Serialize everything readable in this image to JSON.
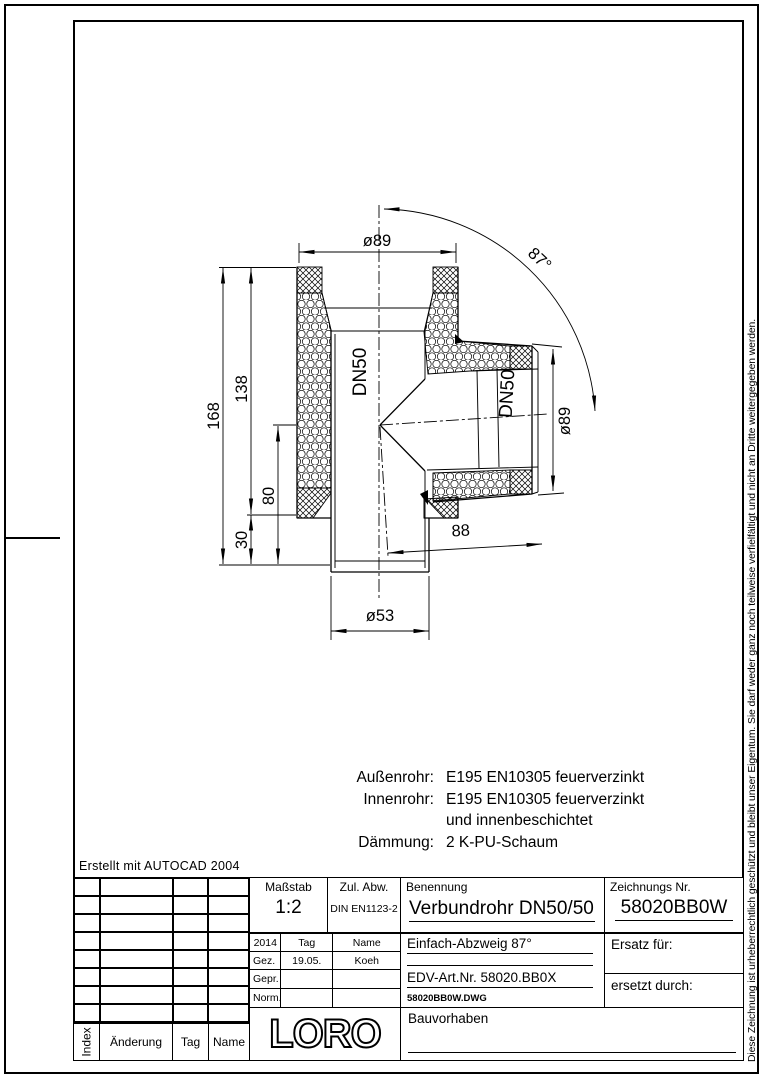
{
  "frame": {
    "created_with": "Erstellt mit AUTOCAD 2004",
    "copyright": "Diese Zeichnung ist urheberrechtlich geschützt und bleibt unser Eigentum. Sie darf weder ganz noch teilweise verfielfältigt und nicht an Dritte weitergegeben werden."
  },
  "drawing": {
    "dims": {
      "dia_top": "ø89",
      "angle": "87°",
      "dn_main": "DN50",
      "dn_branch": "DN50",
      "dia_branch": "ø89",
      "h_total": "168",
      "h_upper": "138",
      "h_branch": "80",
      "h_bottom": "30",
      "branch_len": "88",
      "dia_bottom": "ø53"
    },
    "notes": [
      {
        "label": "Außenrohr:",
        "value": "E195 EN10305 feuerverzinkt"
      },
      {
        "label": "Innenrohr:",
        "value": "E195 EN10305 feuerverzinkt"
      },
      {
        "label": "",
        "value": "und innenbeschichtet"
      },
      {
        "label": "Dämmung:",
        "value": "2 K-PU-Schaum"
      }
    ]
  },
  "title_block": {
    "masstab_label": "Maßstab",
    "masstab_value": "1:2",
    "zul_abw_label": "Zul. Abw.",
    "zul_abw_value": "DIN EN1123-2",
    "benennung_label": "Benennung",
    "benennung_value": "Verbundrohr DN50/50",
    "zeichnung_label": "Zeichnungs Nr.",
    "zeichnung_value": "58020BB0W",
    "year": "2014",
    "tag_label": "Tag",
    "name_label": "Name",
    "gez_label": "Gez.",
    "gez_tag": "19.05.",
    "gez_name": "Koeh",
    "gepr_label": "Gepr.",
    "norm_label": "Norm.",
    "subtitle": "Einfach-Abzweig 87°",
    "edv": "EDV-Art.Nr. 58020.BB0X",
    "dwg_file": "58020BB0W.DWG",
    "ersatz_label": "Ersatz für:",
    "ersetzt_label": "ersetzt durch:",
    "bauvorhaben_label": "Bauvorhaben",
    "logo": "LORO",
    "revision": {
      "index_label": "Index",
      "aenderung_label": "Änderung",
      "tag_label": "Tag",
      "name_label": "Name"
    }
  }
}
